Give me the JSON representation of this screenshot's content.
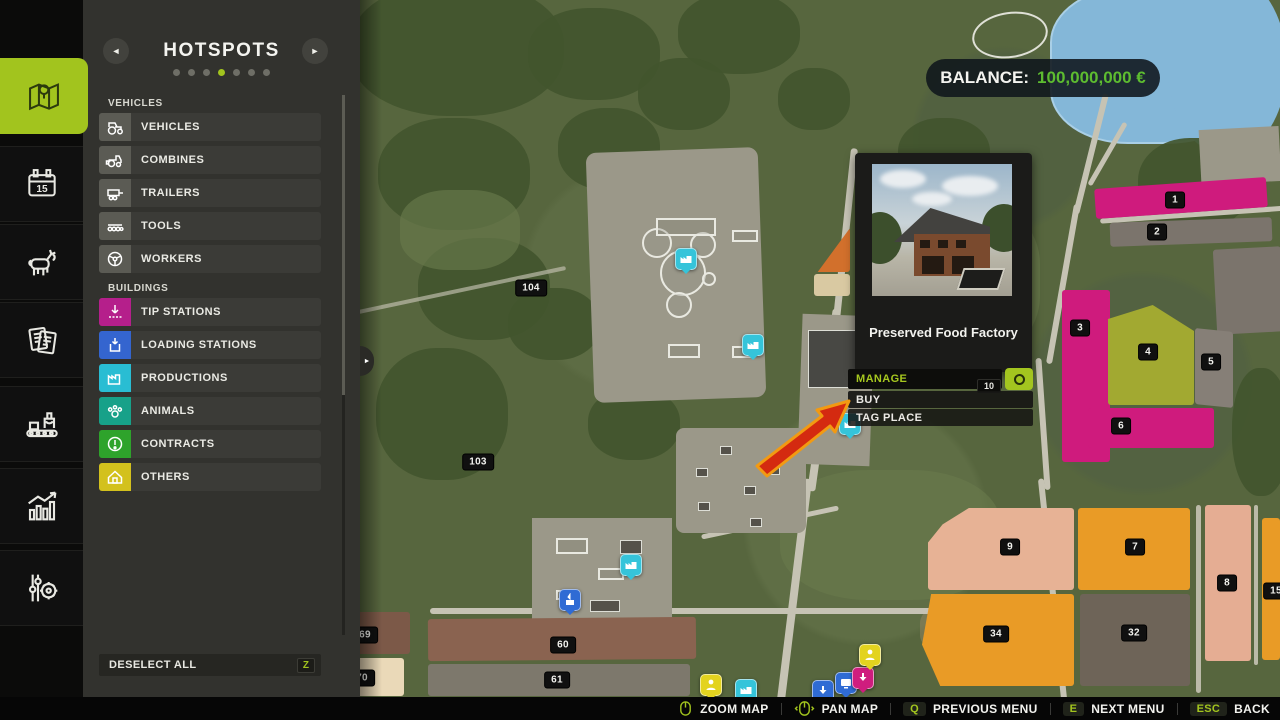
{
  "sidebar": {
    "tabs": [
      {
        "name": "map",
        "icon": "map-icon",
        "active": true
      },
      {
        "name": "calendar",
        "icon": "calendar-icon",
        "active": false,
        "day": "15"
      },
      {
        "name": "animals",
        "icon": "cow-icon",
        "active": false
      },
      {
        "name": "finances",
        "icon": "documents-icon",
        "active": false
      },
      {
        "name": "production",
        "icon": "production-line-icon",
        "active": false
      },
      {
        "name": "statistics",
        "icon": "statistics-icon",
        "active": false
      },
      {
        "name": "settings",
        "icon": "settings-icon",
        "active": false
      }
    ]
  },
  "panel": {
    "title": "HOTSPOTS",
    "pager": {
      "dots": 7,
      "active_index": 3
    },
    "sections": [
      {
        "label": "VEHICLES",
        "items": [
          {
            "label": "VEHICLES",
            "icon": "tractor-icon",
            "icon_bg": "#5b5b54"
          },
          {
            "label": "COMBINES",
            "icon": "combine-icon",
            "icon_bg": "#5b5b54"
          },
          {
            "label": "TRAILERS",
            "icon": "trailer-icon",
            "icon_bg": "#5b5b54"
          },
          {
            "label": "TOOLS",
            "icon": "tools-icon",
            "icon_bg": "#5b5b54"
          },
          {
            "label": "WORKERS",
            "icon": "steering-wheel-icon",
            "icon_bg": "#5b5b54"
          }
        ]
      },
      {
        "label": "BUILDINGS",
        "items": [
          {
            "label": "TIP STATIONS",
            "icon": "tip-station-icon",
            "icon_bg": "#b51f8b"
          },
          {
            "label": "LOADING STATIONS",
            "icon": "loading-station-icon",
            "icon_bg": "#3465cf"
          },
          {
            "label": "PRODUCTIONS",
            "icon": "factory-icon",
            "icon_bg": "#29bdd3"
          },
          {
            "label": "ANIMALS",
            "icon": "paw-icon",
            "icon_bg": "#17a189"
          },
          {
            "label": "CONTRACTS",
            "icon": "contract-icon",
            "icon_bg": "#2ea32b"
          },
          {
            "label": "OTHERS",
            "icon": "house-icon",
            "icon_bg": "#d3c11d"
          }
        ]
      }
    ],
    "deselect_all": {
      "label": "DESELECT ALL",
      "key": "Z"
    }
  },
  "balance": {
    "label": "BALANCE:",
    "value": "100,000,000 €"
  },
  "popup": {
    "title": "Preserved Food Factory",
    "count_badge": "10",
    "menu": [
      {
        "label": "MANAGE",
        "accent": true
      },
      {
        "label": "BUY",
        "accent": false
      },
      {
        "label": "TAG PLACE",
        "accent": false
      }
    ]
  },
  "map": {
    "field_markers": [
      {
        "id": "104",
        "x": 531,
        "y": 288
      },
      {
        "id": "103",
        "x": 478,
        "y": 462
      },
      {
        "id": "1",
        "x": 1175,
        "y": 200
      },
      {
        "id": "2",
        "x": 1157,
        "y": 232
      },
      {
        "id": "3",
        "x": 1080,
        "y": 328
      },
      {
        "id": "4",
        "x": 1148,
        "y": 352
      },
      {
        "id": "5",
        "x": 1211,
        "y": 362
      },
      {
        "id": "6",
        "x": 1121,
        "y": 426
      },
      {
        "id": "9",
        "x": 1010,
        "y": 547
      },
      {
        "id": "7",
        "x": 1135,
        "y": 547
      },
      {
        "id": "8",
        "x": 1227,
        "y": 583
      },
      {
        "id": "34",
        "x": 996,
        "y": 634
      },
      {
        "id": "32",
        "x": 1134,
        "y": 633
      },
      {
        "id": "60",
        "x": 563,
        "y": 645
      },
      {
        "id": "61",
        "x": 557,
        "y": 680
      },
      {
        "id": "69",
        "x": 365,
        "y": 635
      },
      {
        "id": "70",
        "x": 362,
        "y": 678
      },
      {
        "id": "15",
        "x": 1276,
        "y": 591
      }
    ],
    "station_markers": [
      {
        "type": "production",
        "color": "#35c4da",
        "x": 686,
        "y": 259
      },
      {
        "type": "production",
        "color": "#35c4da",
        "x": 753,
        "y": 345
      },
      {
        "type": "production",
        "color": "#35c4da",
        "x": 850,
        "y": 424
      },
      {
        "type": "production",
        "color": "#35c4da",
        "x": 631,
        "y": 565
      },
      {
        "type": "production",
        "color": "#35c4da",
        "x": 746,
        "y": 690
      },
      {
        "type": "loading",
        "color": "#2f6bd4",
        "x": 570,
        "y": 600
      },
      {
        "type": "person",
        "color": "#e3d31f",
        "x": 711,
        "y": 685
      },
      {
        "type": "down-arrow",
        "color": "#2f6bd4",
        "x": 823,
        "y": 691
      },
      {
        "type": "monitor",
        "color": "#2f6bd4",
        "x": 846,
        "y": 683
      },
      {
        "type": "down-arrow",
        "color": "#cf1d7e",
        "x": 863,
        "y": 678
      },
      {
        "type": "person",
        "color": "#e3d31f",
        "x": 870,
        "y": 655
      }
    ]
  },
  "bottom_bar": {
    "items": [
      {
        "icon": "mouse-icon",
        "key": "",
        "label": "ZOOM MAP"
      },
      {
        "icon": "mouse-pan-icon",
        "key": "",
        "label": "PAN MAP"
      },
      {
        "icon": "",
        "key": "Q",
        "label": "PREVIOUS MENU"
      },
      {
        "icon": "",
        "key": "E",
        "label": "NEXT MENU"
      },
      {
        "icon": "",
        "key": "ESC",
        "label": "BACK"
      }
    ]
  },
  "colors": {
    "accent_green": "#a2c41e",
    "balance_green": "#5dbc30"
  }
}
